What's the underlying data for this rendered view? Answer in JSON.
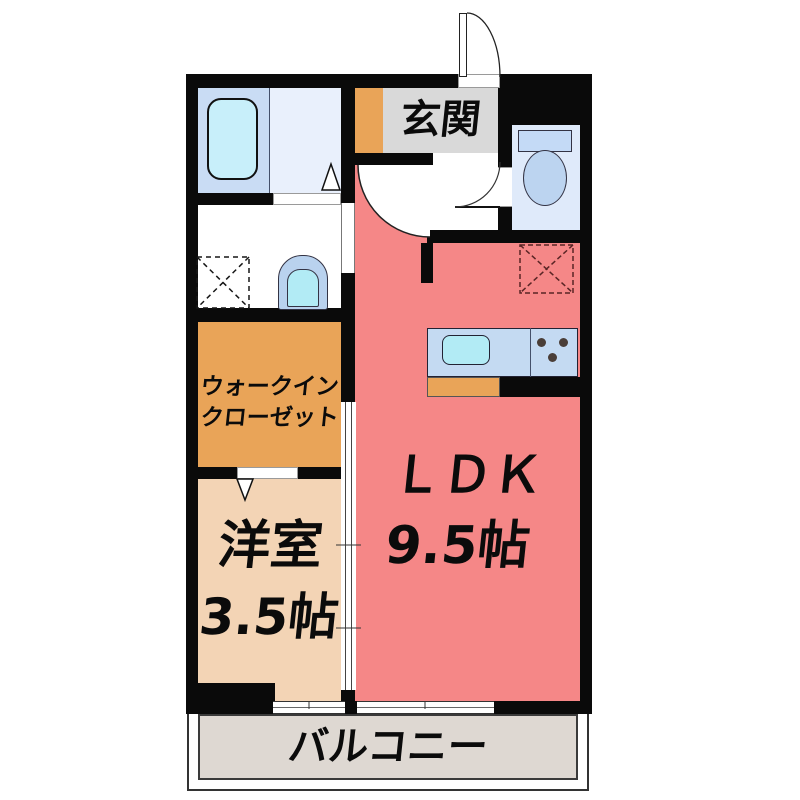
{
  "labels": {
    "genkan": "玄関",
    "ldk_name": "ＬＤＫ",
    "ldk_size": "9.5帖",
    "western_room_name": "洋室",
    "western_room_size": "3.5帖",
    "wic_line1": "ウォークイン",
    "wic_line2": "クローゼット",
    "balcony": "バルコニー"
  },
  "rooms": [
    {
      "name": "LDK",
      "size_tatami": "9.5帖"
    },
    {
      "name": "洋室",
      "size_tatami": "3.5帖"
    },
    {
      "name": "ウォークインクローゼット"
    },
    {
      "name": "玄関"
    },
    {
      "name": "バルコニー"
    }
  ],
  "fixtures": [
    "bathtub",
    "shower-room-folding-door",
    "bathroom-door",
    "washing-machine-space",
    "washbasin",
    "toilet",
    "toilet-door",
    "entrance-door",
    "ldk-door",
    "refrigerator-space",
    "kitchen-counter",
    "kitchen-sink",
    "stove-burners",
    "sliding-door-partition",
    "walk-in-closet-door",
    "western-room-window",
    "ldk-window",
    "balcony-railing"
  ],
  "colors": {
    "wall": "#0a0a0a",
    "ldk-floor": "#f58787",
    "western-room-floor": "#f3d4b5",
    "wic-floor": "#e9a458",
    "shoebox": "#e9a458",
    "genkan-floor": "#d9d9d9",
    "hallway-floor": "#ffffff",
    "balcony-floor": "#ded8d2",
    "bath-floor": "#c9dcf4",
    "shower-floor": "#e9f0fc",
    "bathtub": "#c8effa",
    "toilet-floor": "#dfeafa",
    "fixture-blue": "#c4daf6",
    "bowl-blue": "#bcd4f0",
    "basin-outer": "#b9d2ee",
    "sink-cyan": "#b2ebf5",
    "counter": "#c4daf2",
    "burner": "#4a3e38",
    "fridge-dash": "#5a2525"
  }
}
